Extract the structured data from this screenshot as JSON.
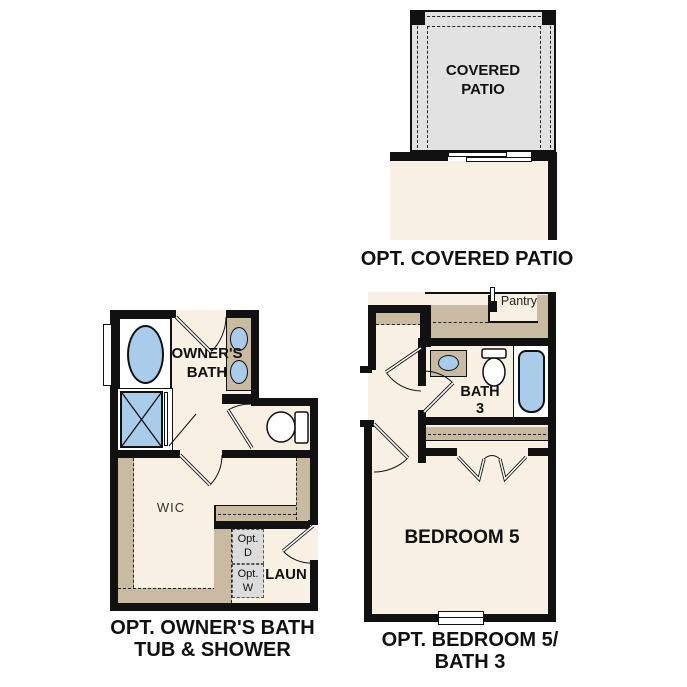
{
  "colors": {
    "wall": "#111111",
    "floor_cream": "#f8f0e2",
    "shelf_tan": "#c8bba1",
    "patio_gray": "#e2e2e2",
    "fixture_blue": "#aacceb",
    "appliance_gray": "#dcdcdc"
  },
  "plans": {
    "covered_patio": {
      "room_label": "COVERED PATIO",
      "caption": "OPT. COVERED PATIO"
    },
    "owners_bath": {
      "bath_label": "OWNER'S BATH",
      "wic_label": "WIC",
      "laun_label": "LAUN",
      "opt_dryer_label": "Opt. D",
      "opt_washer_label": "Opt. W",
      "caption_line1": "OPT. OWNER'S BATH",
      "caption_line2": "TUB & SHOWER"
    },
    "bedroom5_bath3": {
      "pantry_label": "Pantry",
      "bath_label": "BATH 3",
      "bedroom_label": "BEDROOM 5",
      "caption_line1": "OPT. BEDROOM 5/",
      "caption_line2": "BATH 3"
    }
  }
}
